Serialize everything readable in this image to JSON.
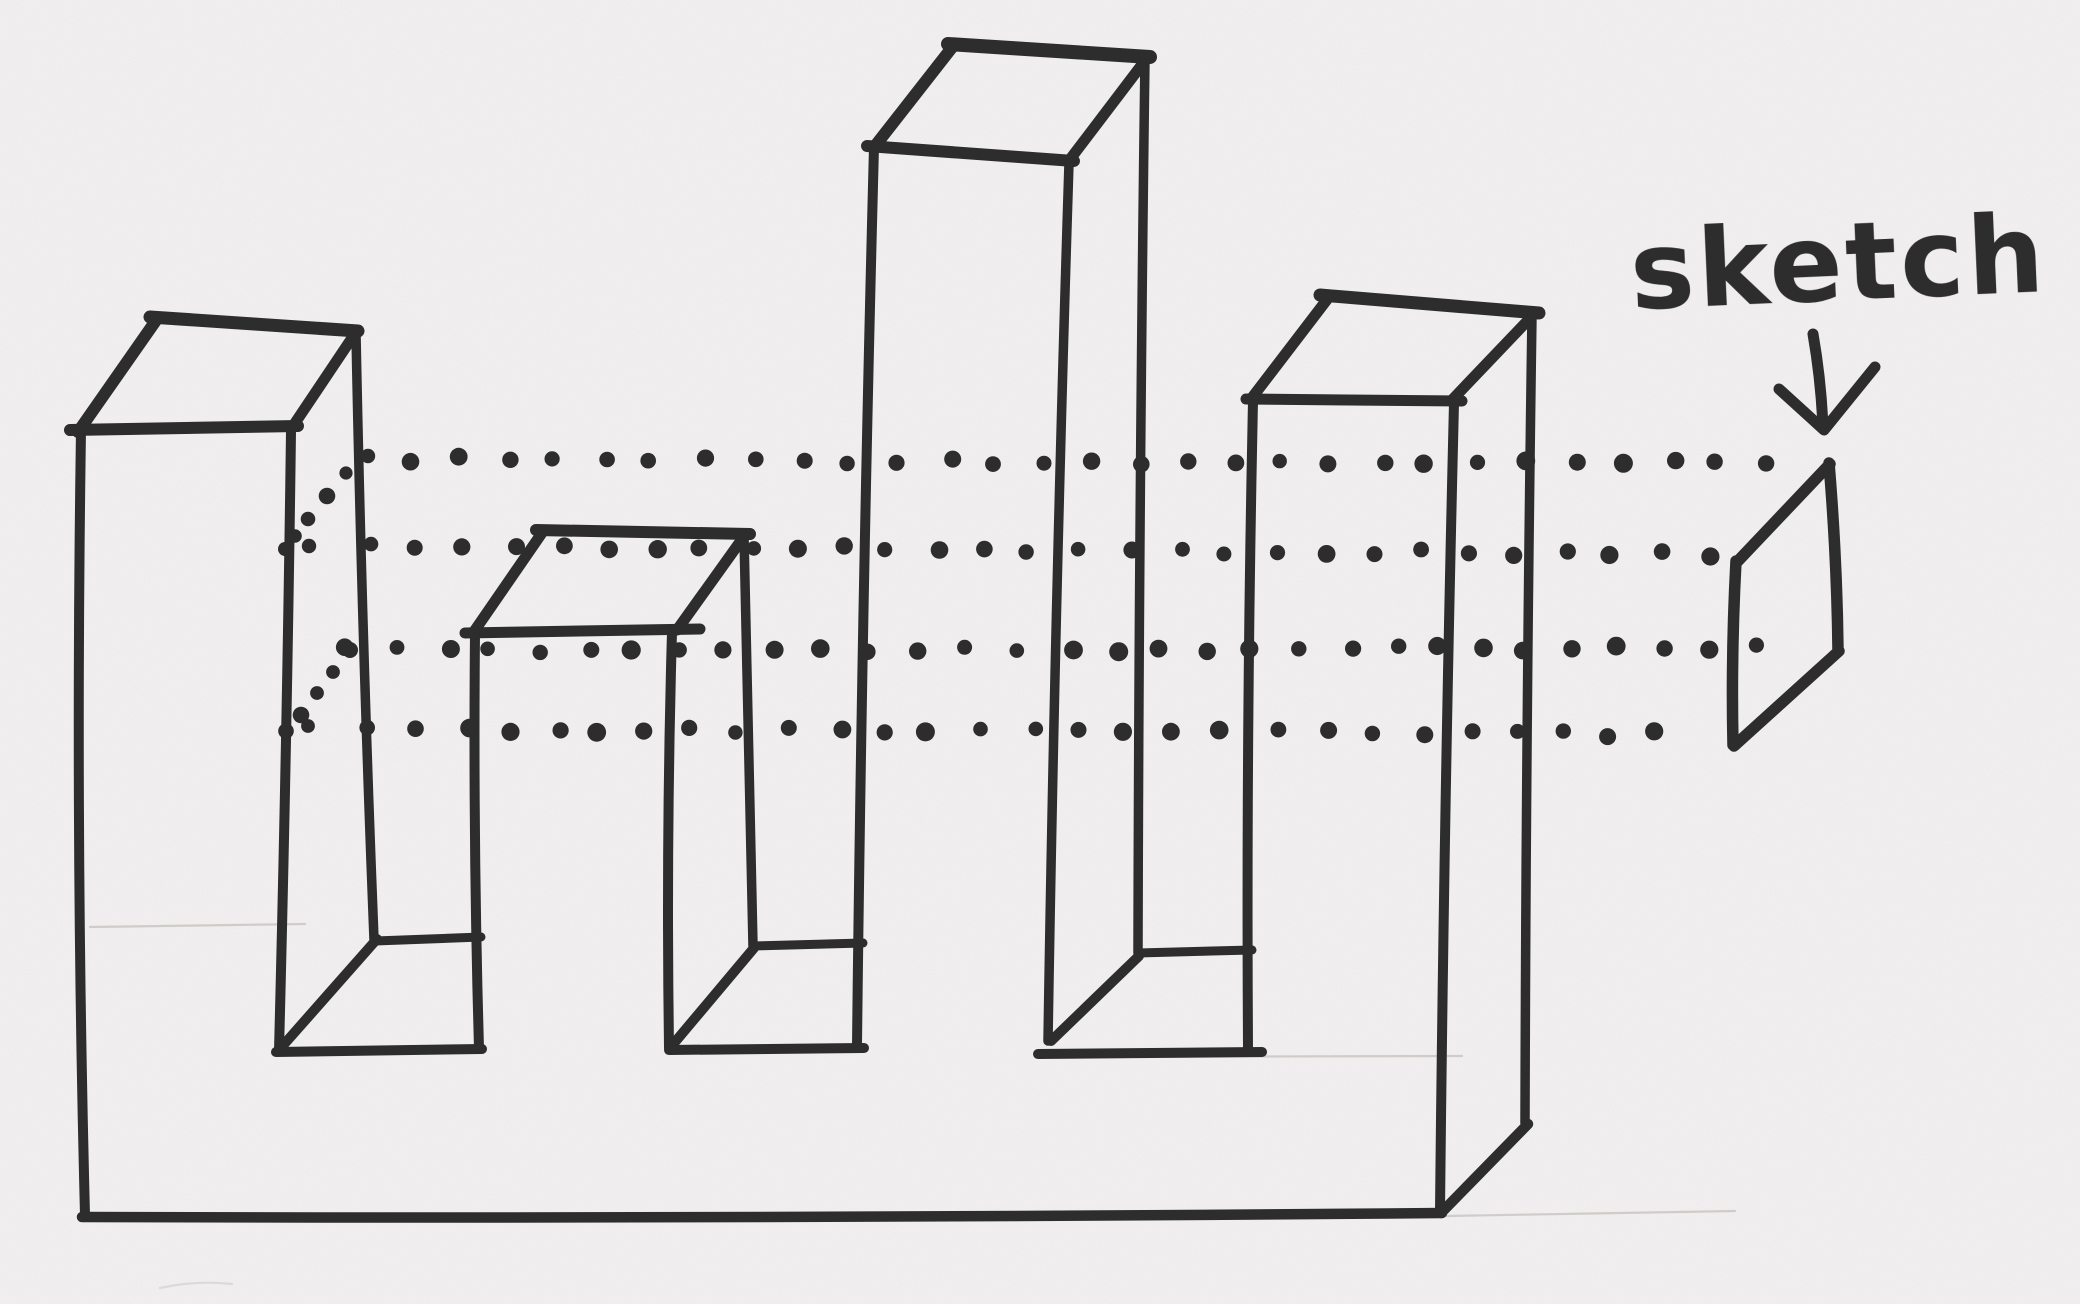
{
  "scene": {
    "description": "hand-drawn marker sketch of a 3D battlement-like block with four towers, dotted section projection lines and a small cross-section parallelogram",
    "paper_color": "#f3f1f1",
    "ink_color": "#2d2d2d",
    "pencil_color": "#c9c6c2"
  },
  "annotation": {
    "label": "sketch",
    "arrow_icon": "down-arrow"
  }
}
